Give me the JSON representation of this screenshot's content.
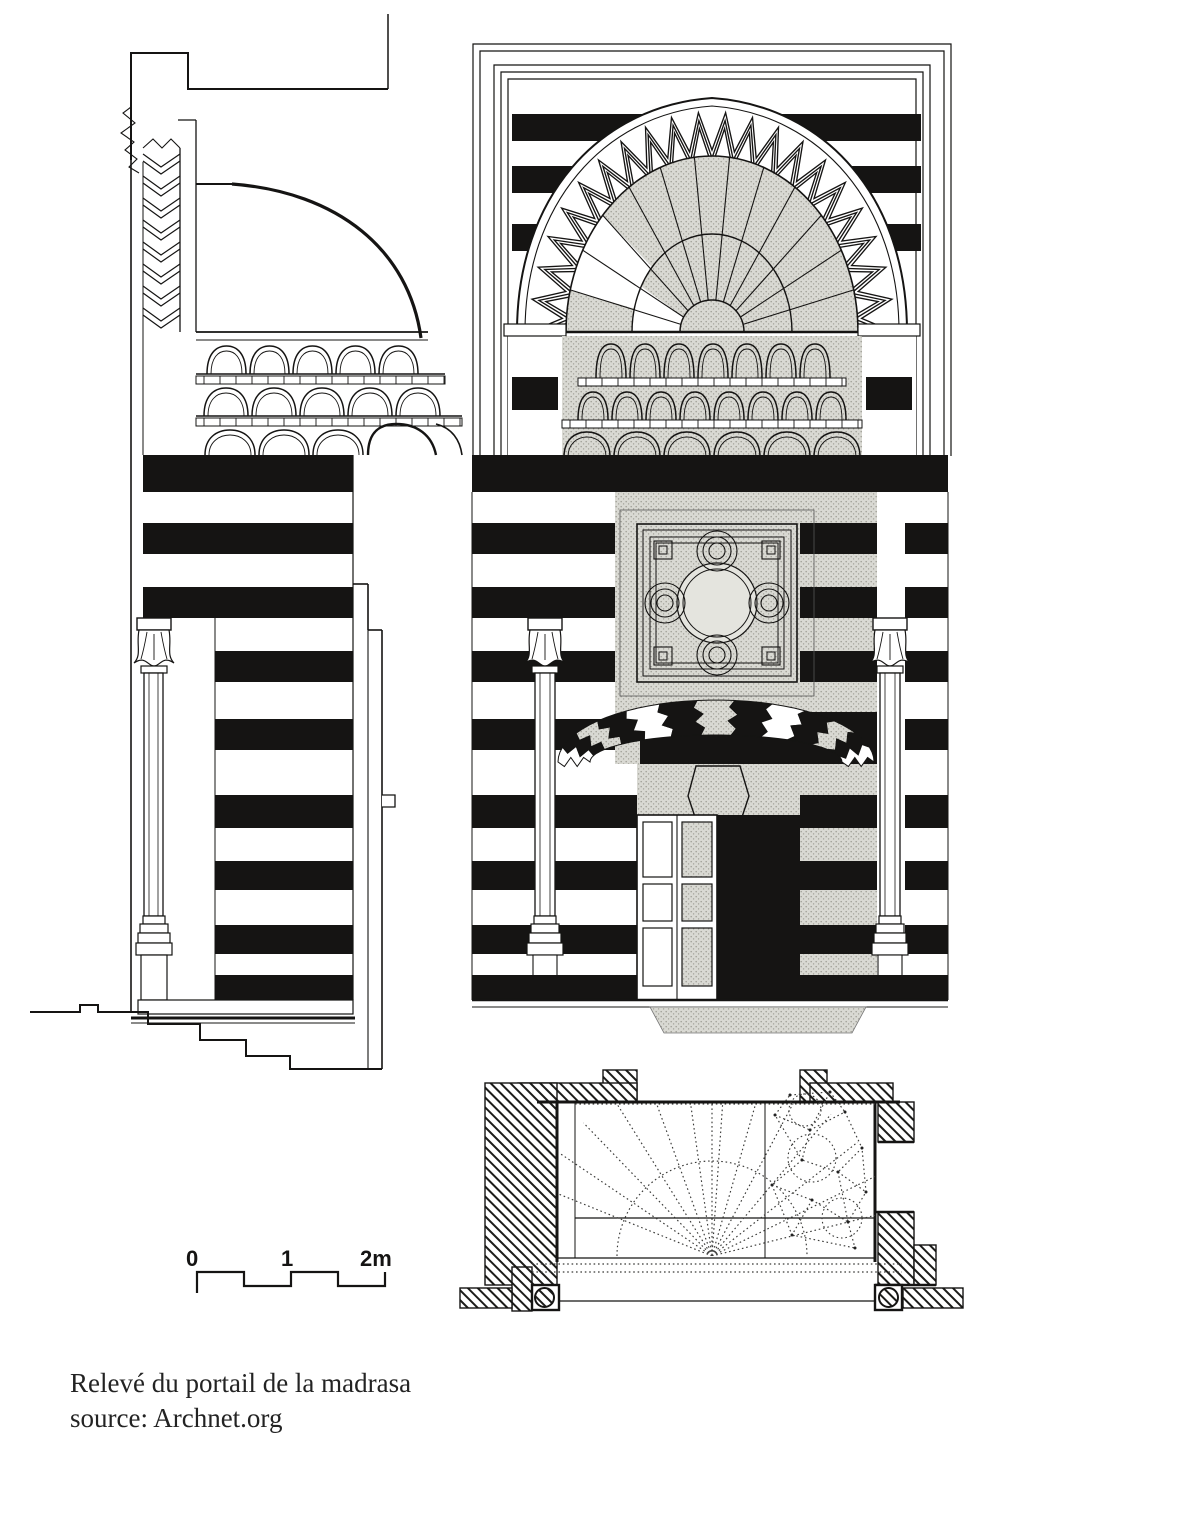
{
  "document": {
    "caption_line1": "Relevé du portail de la madrasa",
    "caption_line2": "source: Archnet.org"
  },
  "scale_bar": {
    "label_0": "0",
    "label_1": "1",
    "label_2": "2m"
  },
  "colors": {
    "ink": "#151413",
    "paper": "#ffffff",
    "stipple_base": "#d9d9d3",
    "stipple_dot": "#9f9e96"
  }
}
